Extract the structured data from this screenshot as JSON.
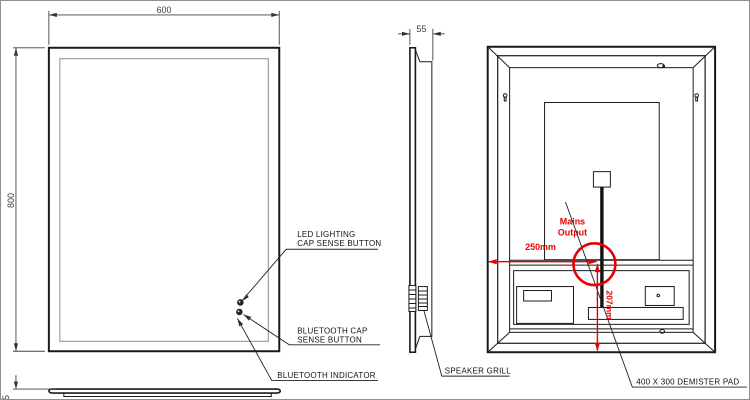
{
  "front_view": {
    "dim_width": "600",
    "dim_height": "800",
    "dim_thickness": "5",
    "label_led_1": "LED LIGHTING",
    "label_led_2": "CAP SENSE BUTTON",
    "label_bt_1": "BLUETOOTH CAP",
    "label_bt_2": "SENSE BUTTON",
    "label_bt_indicator": "BLUETOOTH INDICATOR"
  },
  "side_view": {
    "dim_depth": "55",
    "label_speaker": "SPEAKER GRILL"
  },
  "back_view": {
    "label_mains_1": "Mains",
    "label_mains_2": "Output",
    "dim_horizontal": "250mm",
    "dim_vertical": "207mm",
    "label_demister": "400 X 300 DEMISTER PAD"
  },
  "colors": {
    "line": "#1a1a1a",
    "led_ring": "#8c8c8c",
    "annotation_red": "#e60000",
    "dim_text": "#3d3d3d"
  }
}
